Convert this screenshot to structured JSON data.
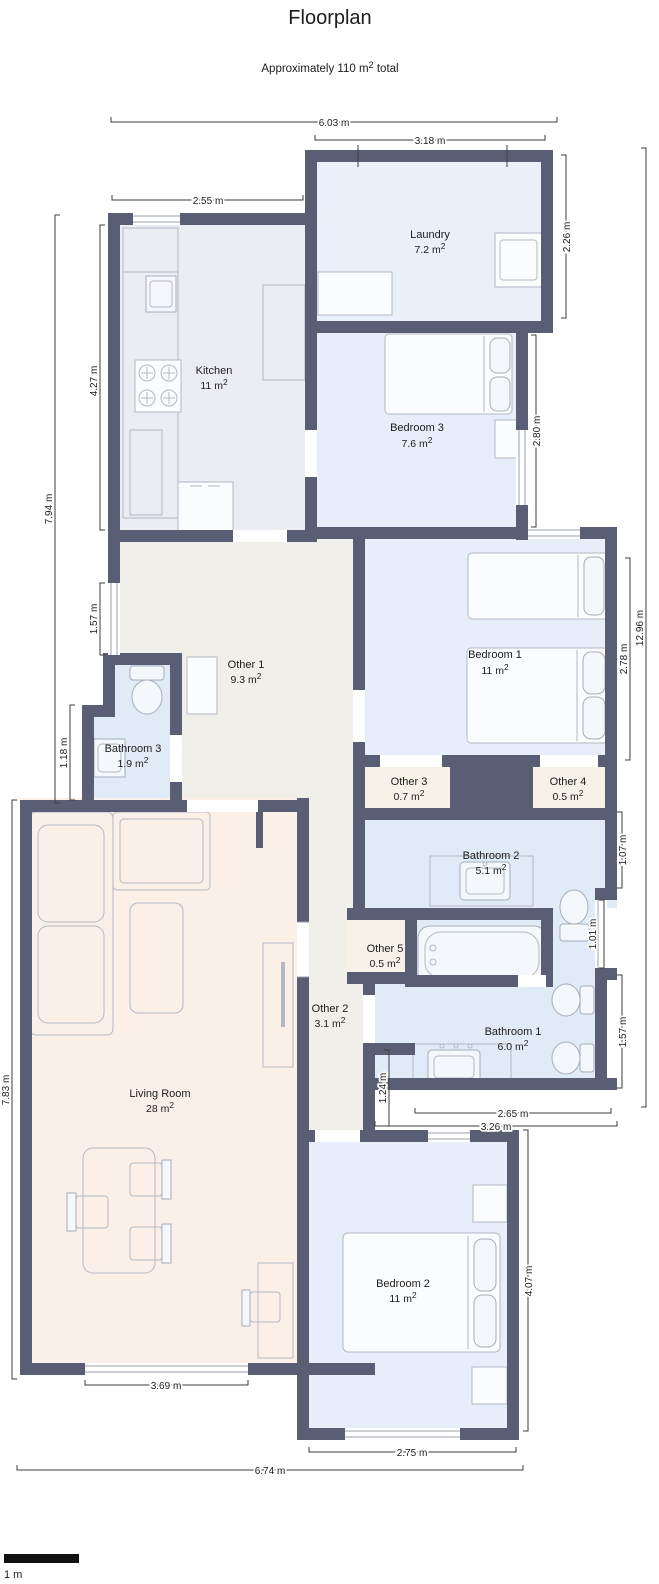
{
  "header": {
    "title": "Floorplan",
    "subtitle": "Approximately 110 m² total"
  },
  "rooms": [
    {
      "name": "Laundry",
      "area": "7.2 m²"
    },
    {
      "name": "Kitchen",
      "area": "11 m²"
    },
    {
      "name": "Bedroom 3",
      "area": "7.6 m²"
    },
    {
      "name": "Other 1",
      "area": "9.3 m²"
    },
    {
      "name": "Bedroom 1",
      "area": "11 m²"
    },
    {
      "name": "Bathroom 3",
      "area": "1.9 m²"
    },
    {
      "name": "Other 3",
      "area": "0.7 m²"
    },
    {
      "name": "Other 4",
      "area": "0.5 m²"
    },
    {
      "name": "Bathroom 2",
      "area": "5.1 m²"
    },
    {
      "name": "Other 5",
      "area": "0.5 m²"
    },
    {
      "name": "Other 2",
      "area": "3.1 m²"
    },
    {
      "name": "Bathroom 1",
      "area": "6.0 m²"
    },
    {
      "name": "Living Room",
      "area": "28 m²"
    },
    {
      "name": "Bedroom 2",
      "area": "11 m²"
    }
  ],
  "dimensions": [
    {
      "label": "6.03 m"
    },
    {
      "label": "3.18 m"
    },
    {
      "label": "2.55 m"
    },
    {
      "label": "2.26 m"
    },
    {
      "label": "4.27 m"
    },
    {
      "label": "7.94 m"
    },
    {
      "label": "2.80 m"
    },
    {
      "label": "1.57 m"
    },
    {
      "label": "12.96 m"
    },
    {
      "label": "2.78 m"
    },
    {
      "label": "1.18 m"
    },
    {
      "label": "1.07 m"
    },
    {
      "label": "1.01 m"
    },
    {
      "label": "1.57 m"
    },
    {
      "label": "7.83 m"
    },
    {
      "label": "1.24 m"
    },
    {
      "label": "2.65 m"
    },
    {
      "label": "3.26 m"
    },
    {
      "label": "4.07 m"
    },
    {
      "label": "3.69 m"
    },
    {
      "label": "2.75 m"
    },
    {
      "label": "6.74 m"
    }
  ],
  "scale_bar": {
    "label": "1 m"
  },
  "colors": {
    "wall": "#5a5e74",
    "room_bedroom": "#e7eef9",
    "room_laundry": "#e9f0fa",
    "room_bathroom": "#e1eaf7",
    "room_kitchen": "#ececf3",
    "room_hall": "#f1efe9",
    "room_living": "#faf0e8",
    "room_niche": "#f6f2e8",
    "scale_bar_fill": "#111111"
  }
}
